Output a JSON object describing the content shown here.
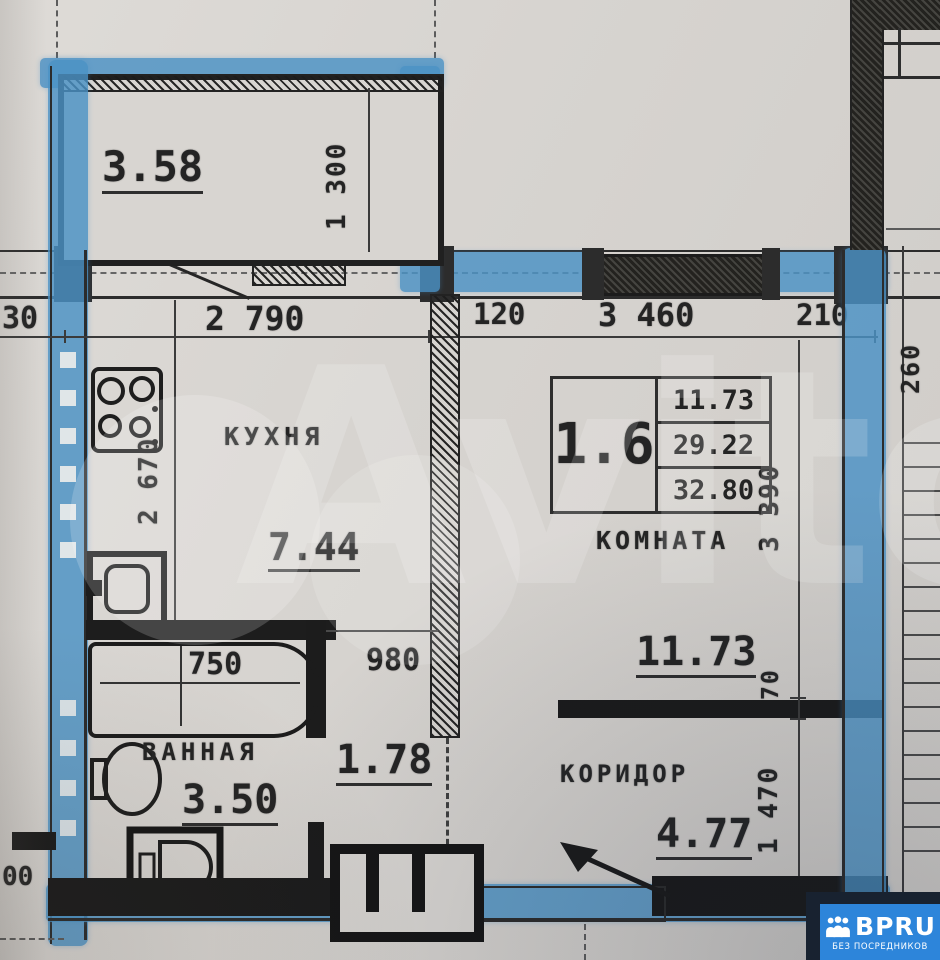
{
  "watermark": {
    "text": "Avito"
  },
  "branding": {
    "name": "BPRU",
    "tagline": "БЕЗ ПОСРЕДНИКОВ"
  },
  "stamp": {
    "unit": "1.6",
    "rows": [
      "11.73",
      "29.22",
      "32.80"
    ]
  },
  "rooms": {
    "balcony": {
      "area": "3.58"
    },
    "kitchen": {
      "label": "КУХНЯ",
      "area": "7.44"
    },
    "living": {
      "label": "КОМНАТА",
      "area": "11.73"
    },
    "bathroom": {
      "label": "ВАННАЯ",
      "area": "3.50"
    },
    "hall": {
      "area": "1.78"
    },
    "corridor": {
      "label": "КОРИДОР",
      "area": "4.77"
    }
  },
  "dimensions": {
    "top_row": {
      "offset": "30",
      "kitchen_width": "2 790",
      "partition": "120",
      "room_width": "3 460",
      "right": "210"
    },
    "balcony_depth": "1 300",
    "kitchen_depth": "2 670",
    "bathtub_length": "750",
    "bath_opening": "980",
    "room_depth": "3 390",
    "wall_thickness": "70",
    "corridor_depth": "1 470",
    "stair_width": "260",
    "bottom_cut": "00"
  },
  "colors": {
    "marker_blue": "#4b92c5",
    "brand_blue": "#2d85da",
    "ink": "#242424",
    "paper": "#d8d5d1"
  }
}
